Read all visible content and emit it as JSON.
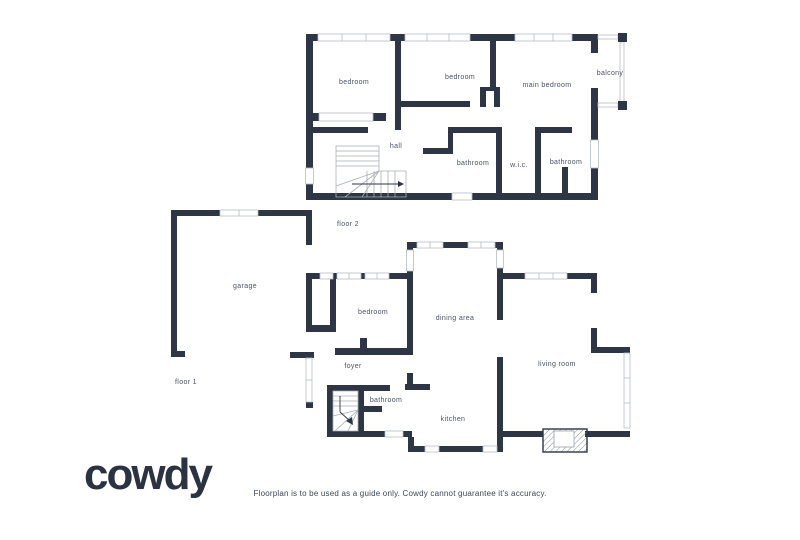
{
  "brand": {
    "name": "cowdy"
  },
  "disclaimer": "Floorplan is to be used as a guide only. Cowdy cannot guarantee it's accuracy.",
  "colors": {
    "wall": "#2e3544",
    "window_stroke": "#b6bcc6",
    "stair_line": "#a8aeb8",
    "label": "#4b5262",
    "logo": "#2b3342",
    "disclaimer_text": "#3f4653"
  },
  "floor2": {
    "label": "floor 2",
    "rooms": {
      "bedroom_left": "bedroom",
      "bedroom_middle": "bedroom",
      "main_bedroom": "main bedroom",
      "balcony": "balcony",
      "hall": "hall",
      "bathroom_center": "bathroom",
      "wic": "w.i.c.",
      "bathroom_right": "bathroom"
    }
  },
  "floor1": {
    "label": "floor 1",
    "rooms": {
      "garage": "garage",
      "bedroom": "bedroom",
      "dining_area": "dining area",
      "foyer": "foyer",
      "bathroom": "bathroom",
      "kitchen": "kitchen",
      "living_room": "living room"
    }
  }
}
